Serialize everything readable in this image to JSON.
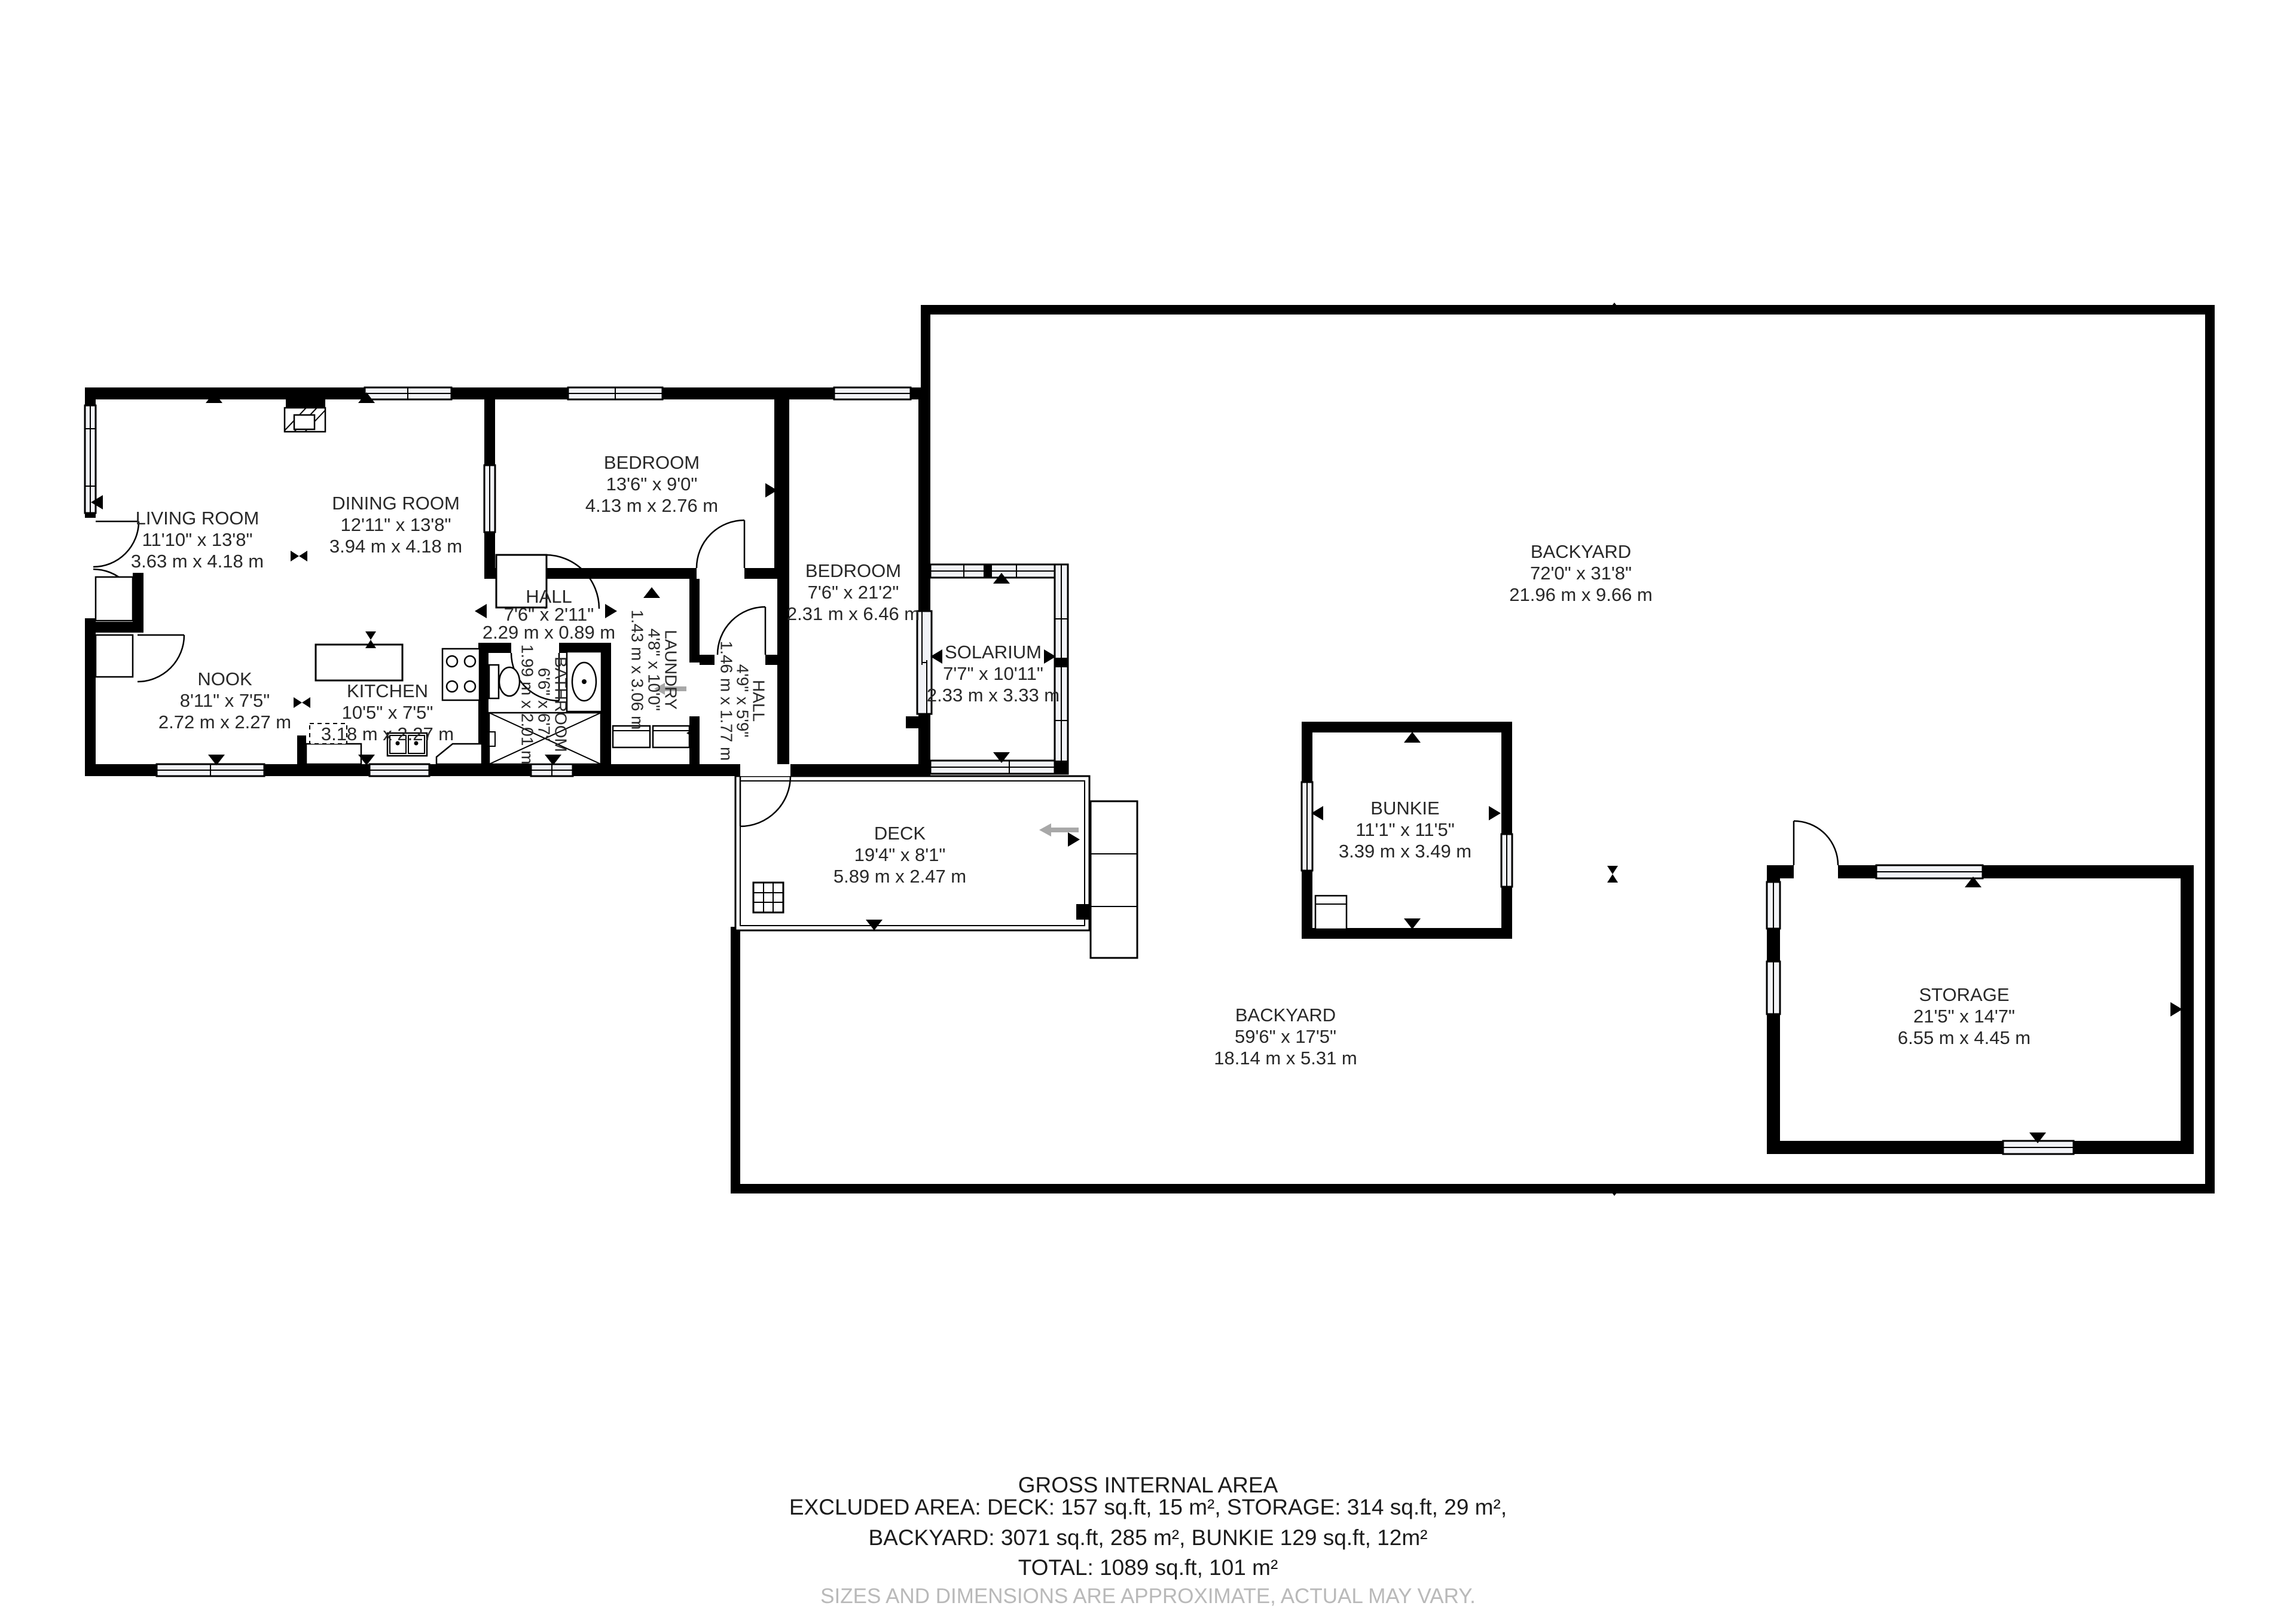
{
  "plan": {
    "rooms": [
      {
        "id": "living-room",
        "name": "LIVING ROOM",
        "imperial": "11'10\" x 13'8\"",
        "metric": "3.63 m x 4.18 m"
      },
      {
        "id": "dining-room",
        "name": "DINING ROOM",
        "imperial": "12'11\" x 13'8\"",
        "metric": "3.94 m x 4.18 m"
      },
      {
        "id": "bedroom-top",
        "name": "BEDROOM",
        "imperial": "13'6\" x 9'0\"",
        "metric": "4.13 m x 2.76 m"
      },
      {
        "id": "hall",
        "name": "HALL",
        "imperial": "7'6\" x 2'11\"",
        "metric": "2.29 m x 0.89 m"
      },
      {
        "id": "bathroom",
        "name": "BATHROOM",
        "imperial": "6'6\" x 6'7\"",
        "metric": "1.99 m x 2.01 m"
      },
      {
        "id": "laundry",
        "name": "LAUNDRY",
        "imperial": "4'8\" x 10'0\"",
        "metric": "1.43 m x 3.06 m"
      },
      {
        "id": "hall-rear",
        "name": "HALL",
        "imperial": "4'9\" x 5'9\"",
        "metric": "1.46 m x 1.77 m"
      },
      {
        "id": "nook",
        "name": "NOOK",
        "imperial": "8'11\" x 7'5\"",
        "metric": "2.72 m x 2.27 m"
      },
      {
        "id": "kitchen",
        "name": "KITCHEN",
        "imperial": "10'5\" x 7'5\"",
        "metric": "3.18 m x 2.27 m"
      },
      {
        "id": "bedroom-right",
        "name": "BEDROOM",
        "imperial": "7'6\" x 21'2\"",
        "metric": "2.31 m x 6.46 m"
      },
      {
        "id": "solarium",
        "name": "SOLARIUM",
        "imperial": "7'7\" x 10'11\"",
        "metric": "2.33 m x 3.33 m"
      },
      {
        "id": "backyard-upper",
        "name": "BACKYARD",
        "imperial": "72'0\" x 31'8\"",
        "metric": "21.96 m x 9.66 m"
      },
      {
        "id": "bunkie",
        "name": "BUNKIE",
        "imperial": "11'1\" x 11'5\"",
        "metric": "3.39 m x 3.49 m"
      },
      {
        "id": "deck",
        "name": "DECK",
        "imperial": "19'4\" x 8'1\"",
        "metric": "5.89 m x 2.47 m"
      },
      {
        "id": "backyard-lower",
        "name": "BACKYARD",
        "imperial": "59'6\" x 17'5\"",
        "metric": "18.14 m x 5.31 m"
      },
      {
        "id": "storage",
        "name": "STORAGE",
        "imperial": "21'5\" x 14'7\"",
        "metric": "6.55 m x 4.45 m"
      }
    ],
    "footer": {
      "title": "GROSS INTERNAL AREA",
      "line1": "EXCLUDED AREA: DECK: 157 sq.ft, 15 m², STORAGE: 314 sq.ft, 29 m²,",
      "line2": "BACKYARD: 3071 sq.ft, 285 m², BUNKIE 129 sq.ft, 12m²",
      "line3": "TOTAL: 1089 sq.ft, 101 m²",
      "disclaimer": "SIZES AND DIMENSIONS ARE APPROXIMATE, ACTUAL MAY VARY."
    },
    "colors": {
      "wall": "#000000",
      "glass": "#f2f3f7",
      "text": "#282828",
      "disclaimer": "#b9b9b9"
    }
  }
}
